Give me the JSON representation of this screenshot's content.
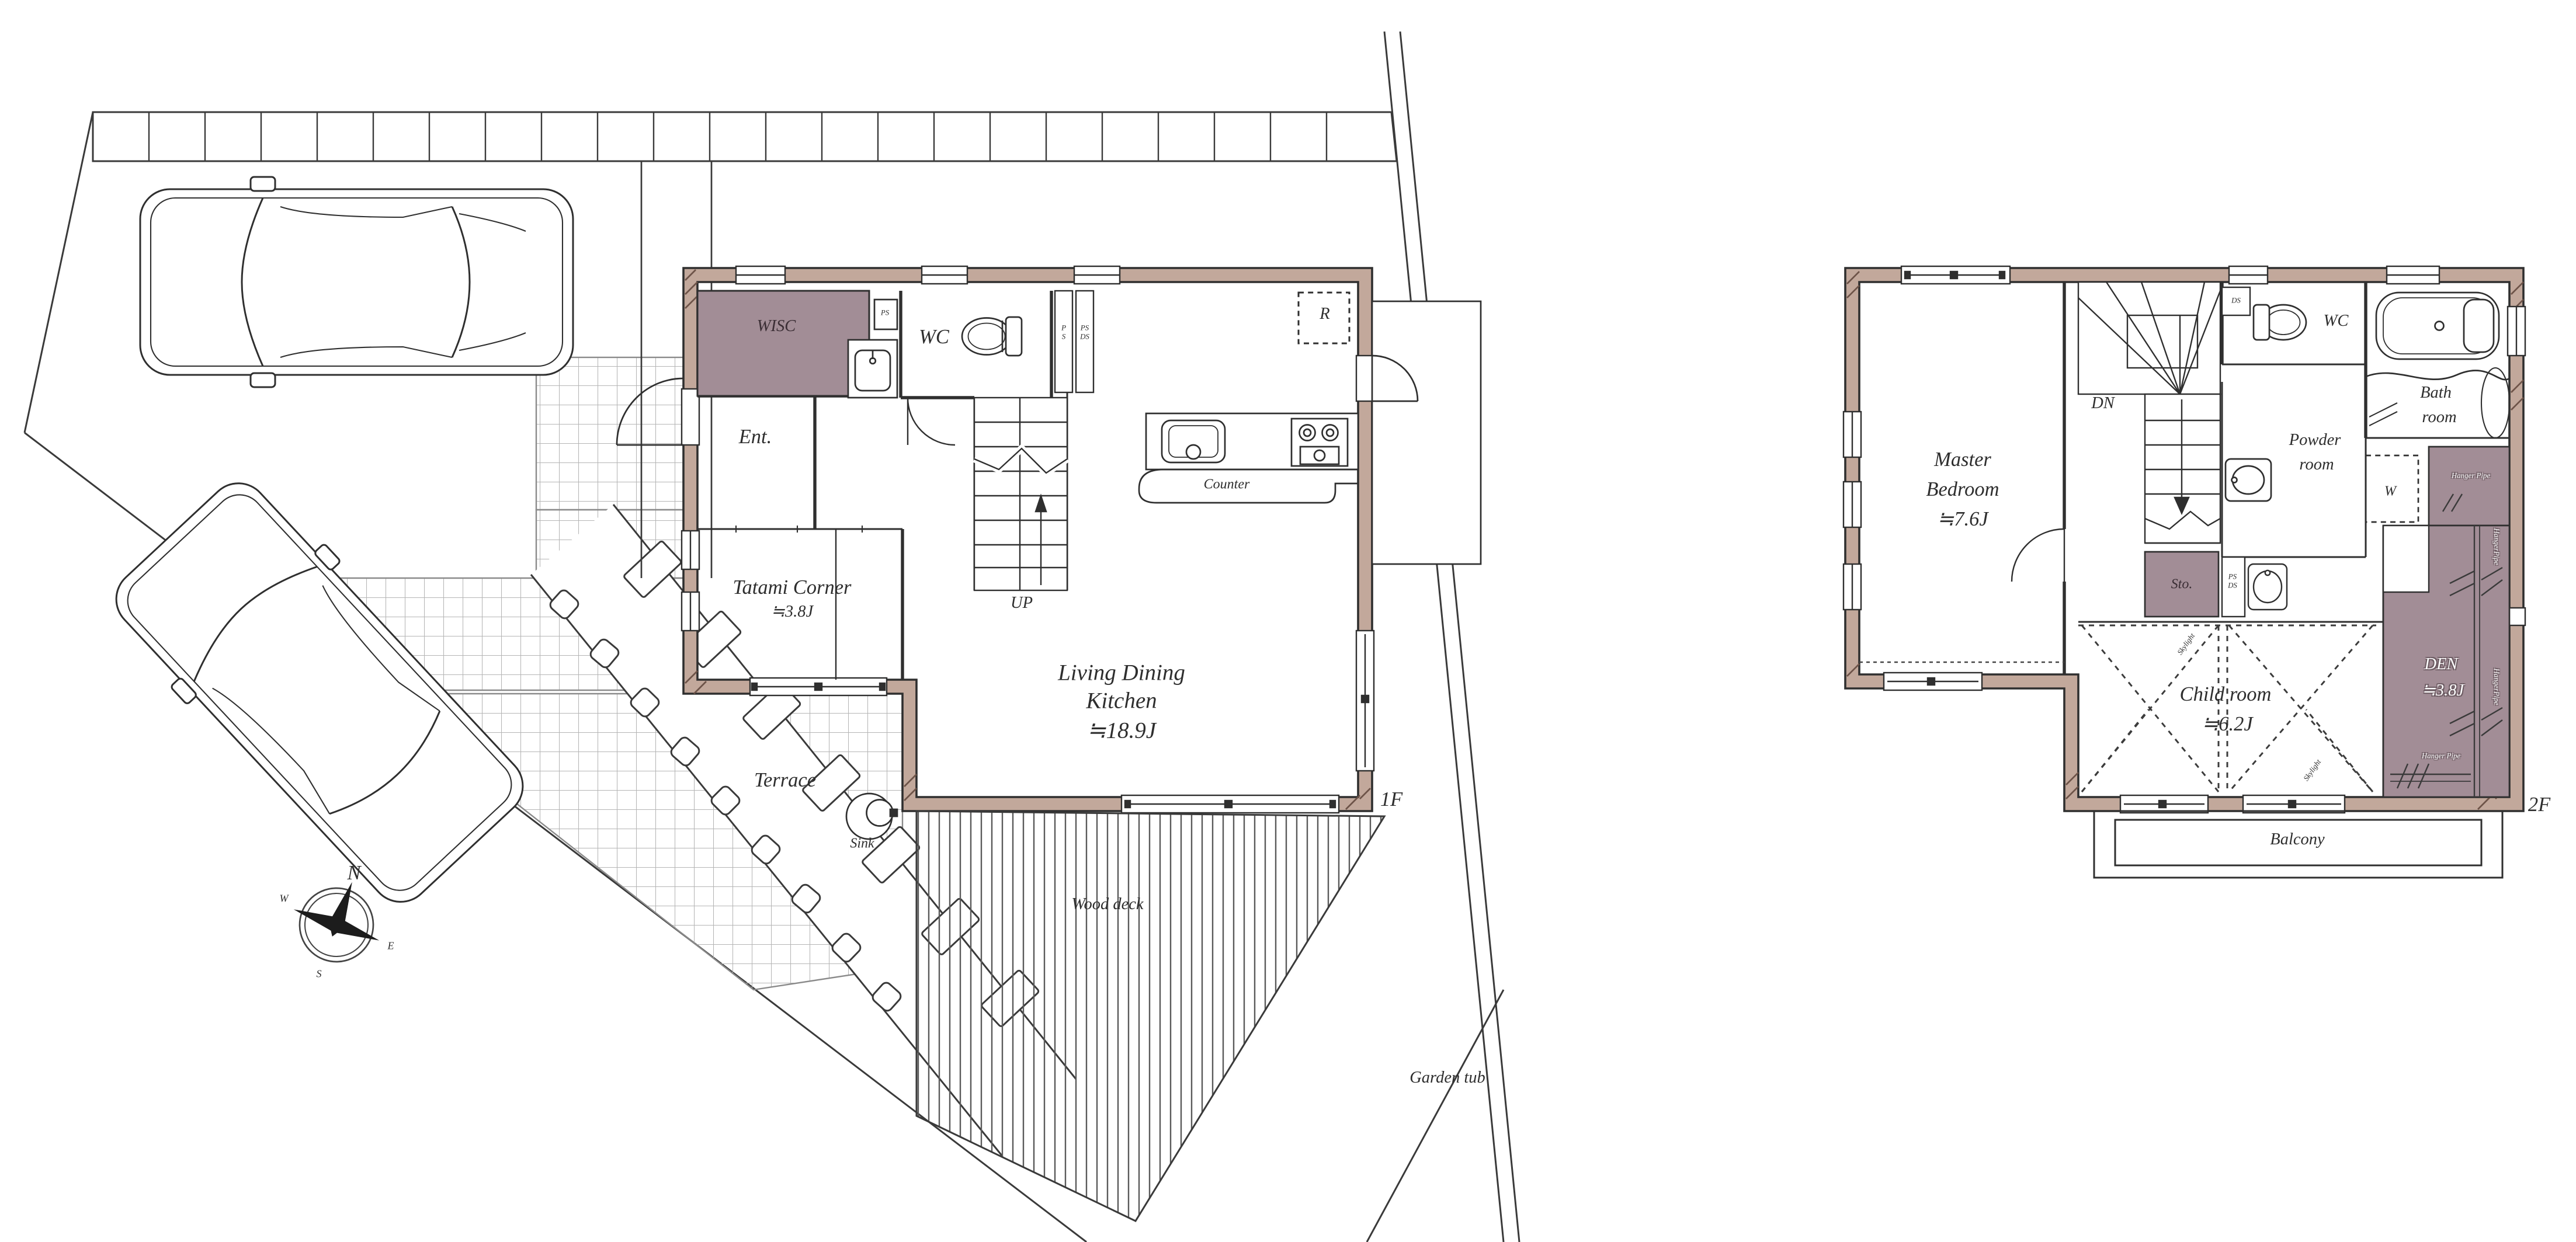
{
  "document": {
    "type": "floor-plan",
    "floors": [
      "1F",
      "2F"
    ]
  },
  "colors": {
    "wall": "#c2a89b",
    "accent_room": "#a28d96",
    "line": "#2f2f2f",
    "grid": "#bbbbbb"
  },
  "floor1": {
    "floor_tag": "1F",
    "labels": {
      "wisc": "WISC",
      "ps_box": "PS",
      "wc": "WC",
      "shaft_p": "P",
      "shaft_s": "S",
      "shaft_ps": "PS",
      "shaft_ds": "DS",
      "ent": "Ent.",
      "up": "UP",
      "counter": "Counter",
      "fridge": "R",
      "tatami_name": "Tatami Corner",
      "tatami_size": "≒3.8J",
      "ldk_line1": "Living Dining",
      "ldk_line2": "Kitchen",
      "ldk_size": "≒18.9J",
      "terrace": "Terrace",
      "sink": "Sink",
      "wood_deck": "Wood deck",
      "garden_tub": "Garden tub"
    },
    "compass": {
      "n": "N",
      "e": "E",
      "s": "S",
      "w": "W"
    }
  },
  "floor2": {
    "floor_tag": "2F",
    "labels": {
      "master_line1": "Master",
      "master_line2": "Bedroom",
      "master_size": "≒7.6J",
      "dn": "DN",
      "ds_box": "DS",
      "wc": "WC",
      "bath_line1": "Bath",
      "bath_line2": "room",
      "powder_line1": "Powder",
      "powder_line2": "room",
      "washer": "W",
      "sto": "Sto.",
      "shaft_ps": "PS",
      "shaft_ds": "DS",
      "hanger_pipe_top": "Hanger Pipe",
      "hanger_pipe_v1": "HangerPipe",
      "hanger_pipe_v2": "HangerPipe",
      "hanger_pipe_bottom": "Hanger Pipe",
      "skylight_1": "Skylight",
      "skylight_2": "Skylight",
      "child_name": "Child room",
      "child_size": "≒6.2J",
      "den_name": "DEN",
      "den_size": "≒3.8J",
      "balcony": "Balcony"
    }
  }
}
